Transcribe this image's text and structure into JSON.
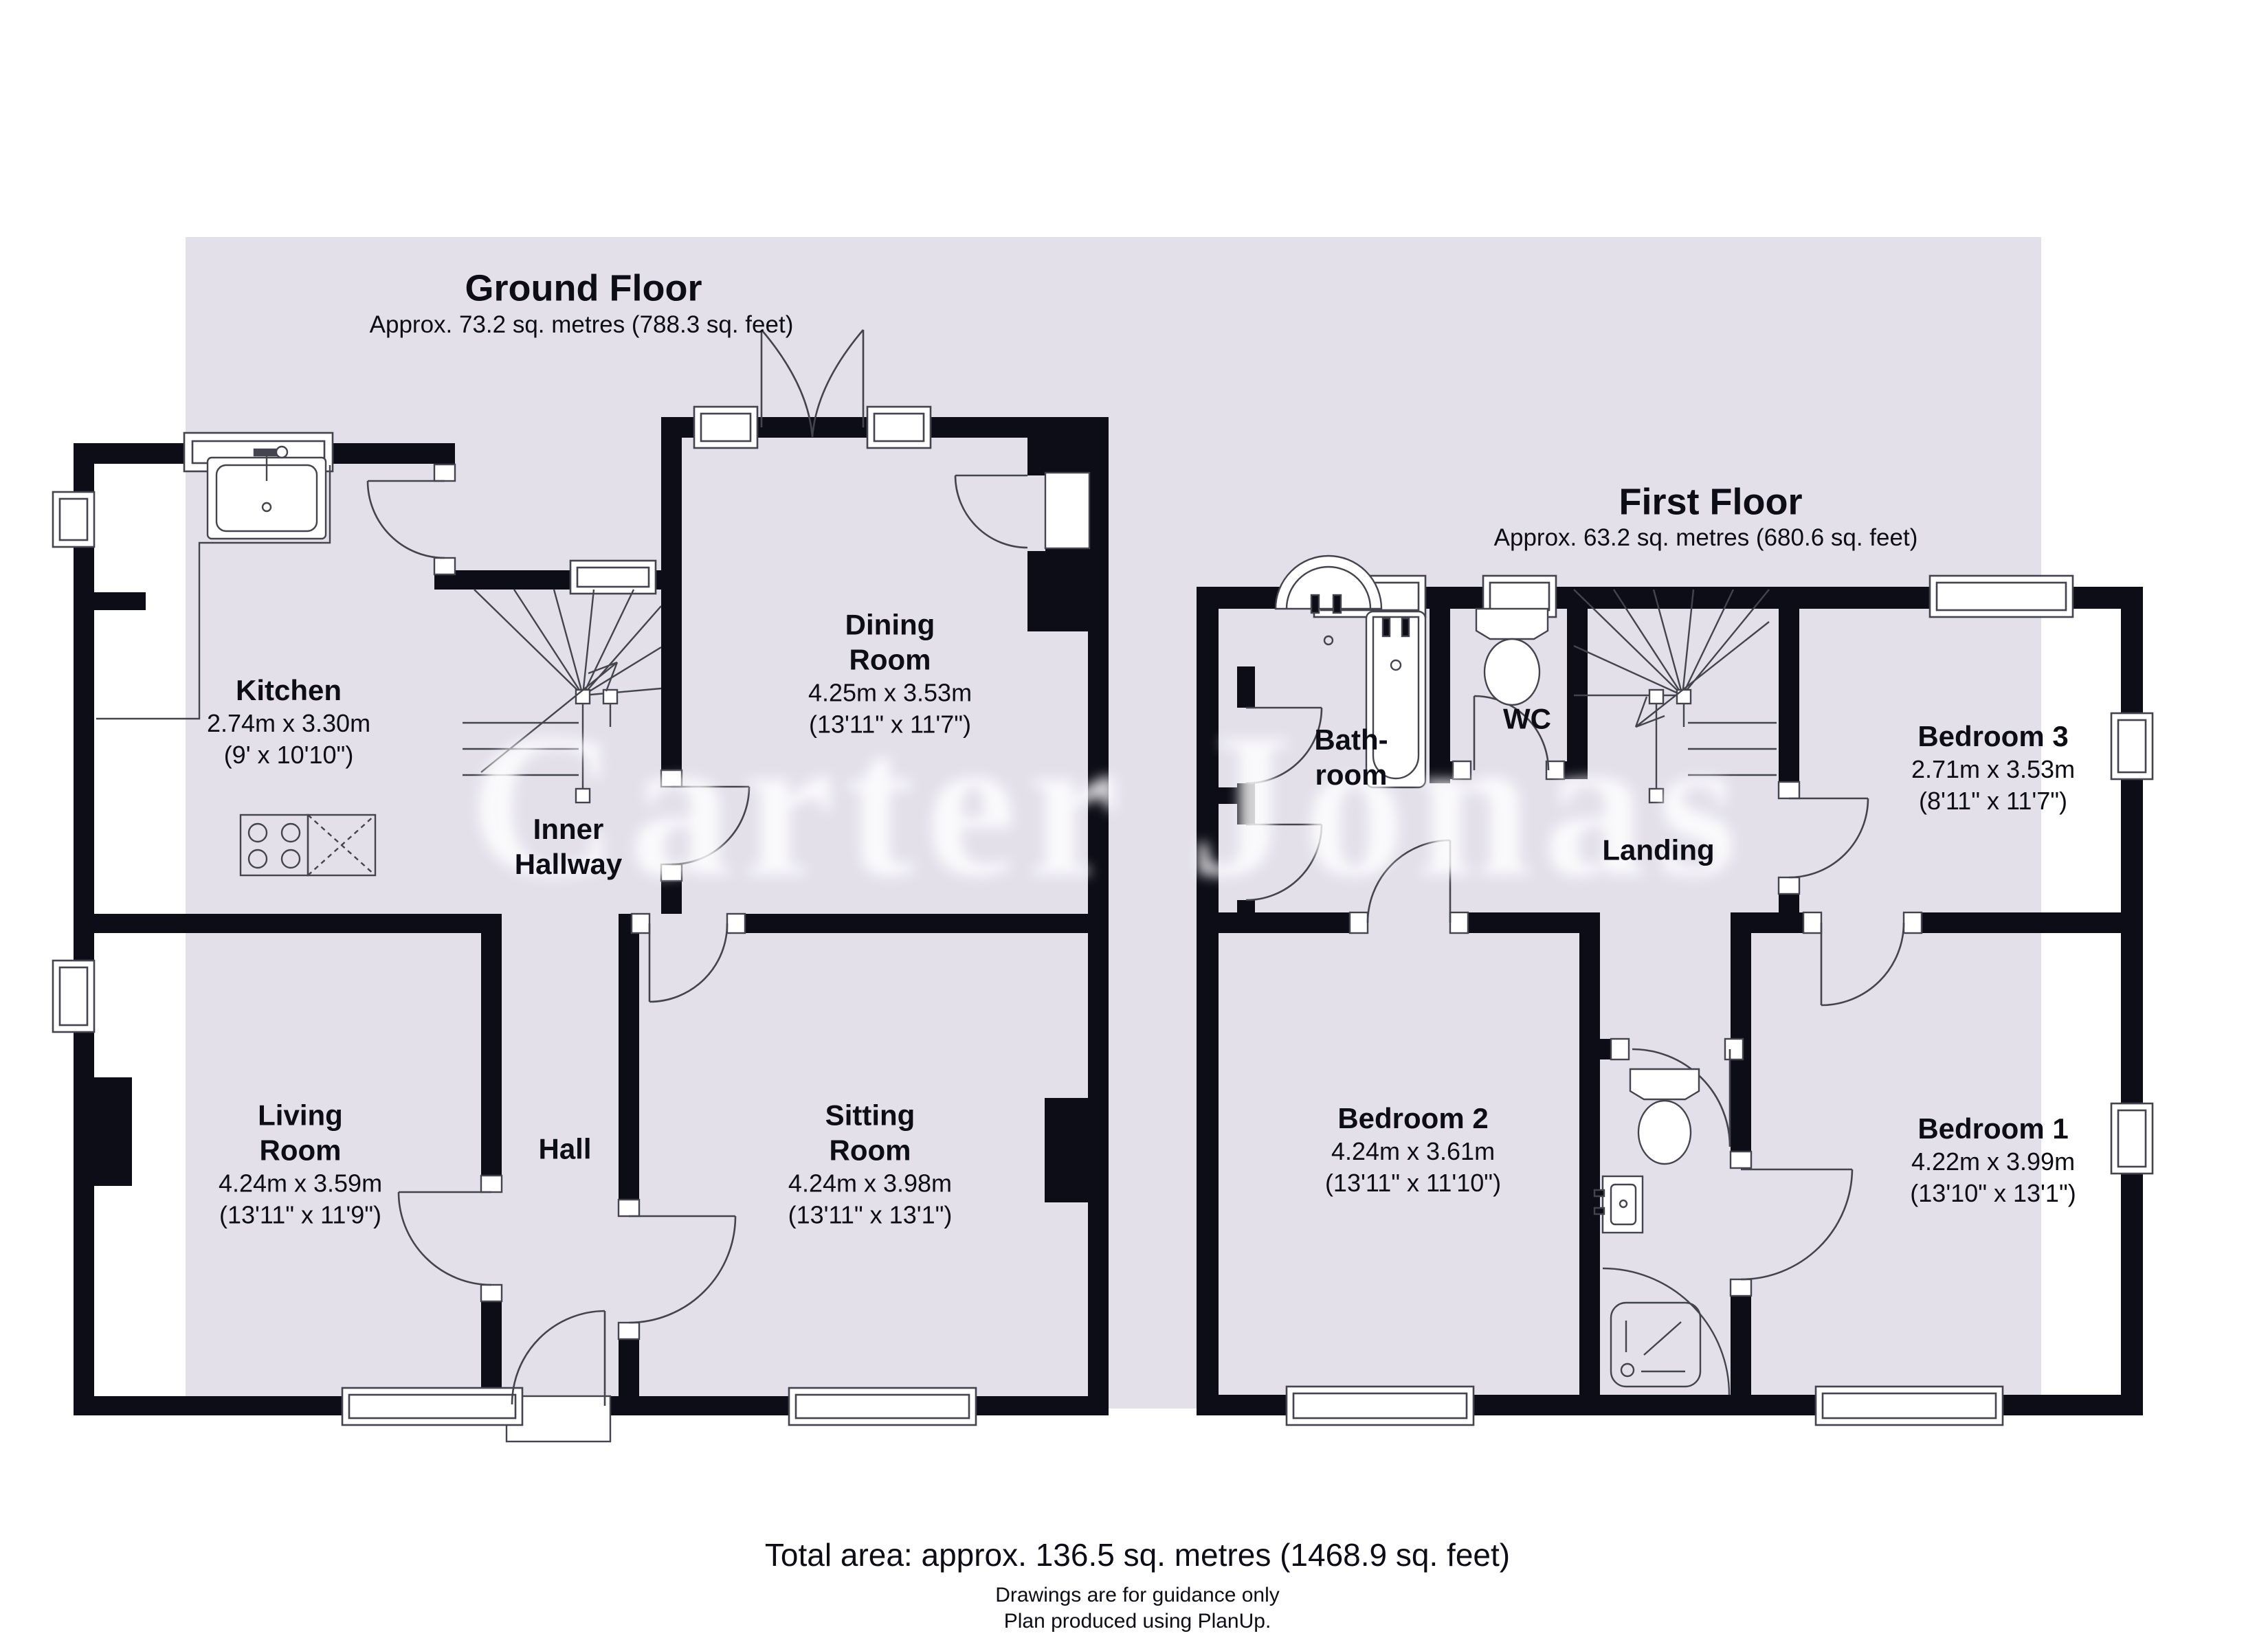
{
  "watermark": "Carter Jonas",
  "ground": {
    "title": "Ground Floor",
    "area": "Approx. 73.2 sq. metres (788.3 sq. feet)",
    "rooms": {
      "kitchen": {
        "name": "Kitchen",
        "metric": "2.74m x 3.30m",
        "imperial": "(9' x 10'10\")"
      },
      "dining": {
        "line1": "Dining",
        "line2": "Room",
        "metric": "4.25m x 3.53m",
        "imperial": "(13'11\" x 11'7\")"
      },
      "inner": {
        "line1": "Inner",
        "line2": "Hallway"
      },
      "living": {
        "line1": "Living",
        "line2": "Room",
        "metric": "4.24m x 3.59m",
        "imperial": "(13'11\" x 11'9\")"
      },
      "hall": {
        "name": "Hall"
      },
      "sitting": {
        "line1": "Sitting",
        "line2": "Room",
        "metric": "4.24m x 3.98m",
        "imperial": "(13'11\" x 13'1\")"
      }
    }
  },
  "first": {
    "title": "First Floor",
    "area": "Approx. 63.2 sq. metres (680.6 sq. feet)",
    "rooms": {
      "bathroom": {
        "line1": "Bath-",
        "line2": "room"
      },
      "wc": {
        "name": "WC"
      },
      "landing": {
        "name": "Landing"
      },
      "bedroom3": {
        "name": "Bedroom 3",
        "metric": "2.71m x 3.53m",
        "imperial": "(8'11\" x 11'7\")"
      },
      "bedroom2": {
        "name": "Bedroom 2",
        "metric": "4.24m x 3.61m",
        "imperial": "(13'11\" x 11'10\")"
      },
      "bedroom1": {
        "name": "Bedroom 1",
        "metric": "4.22m x 3.99m",
        "imperial": "(13'10\" x 13'1\")"
      }
    }
  },
  "footer": {
    "total": "Total area: approx. 136.5 sq. metres (1468.9 sq. feet)",
    "note1": "Drawings are for guidance only",
    "note2": "Plan produced using PlanUp."
  },
  "colors": {
    "wall": "#0d0d17",
    "line": "#44444f",
    "highlight": "#e3e0ea"
  }
}
